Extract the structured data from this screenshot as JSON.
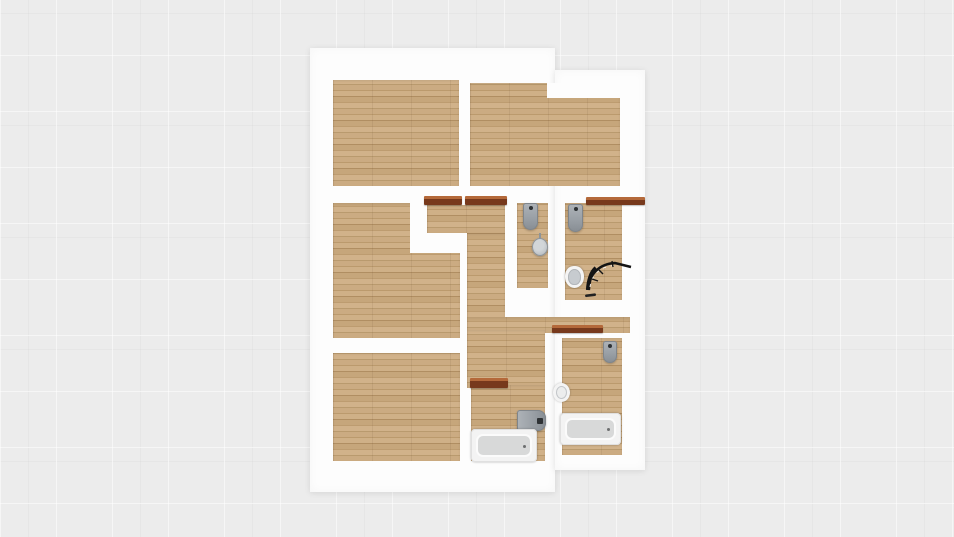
{
  "app": {
    "name": "floor-plan-viewer",
    "view": "2d-top-down-render",
    "visible_text": "none"
  },
  "palette": {
    "background": "#ececec",
    "wall": "#fdfdfd",
    "floor_base": "#c7a77c",
    "floor_dark": "#b08e62",
    "floor_light": "#d1b28a",
    "door_frame_dark": "#77391c",
    "door_frame_light": "#b4693a",
    "fixture_gray": "#9aa0a6",
    "fixture_white": "#f4f4f4",
    "tub_inner": "#d8d9d9",
    "shower_frame": "#141414"
  },
  "plan": {
    "blocks": [
      {
        "id": "building-block-main",
        "rect": [
          310,
          48,
          245,
          444
        ]
      },
      {
        "id": "building-block-right",
        "rect": [
          555,
          70,
          90,
          400
        ]
      }
    ],
    "rooms": [
      {
        "id": "floor-bedroom-top-left",
        "rect": [
          333,
          80,
          126,
          106
        ]
      },
      {
        "id": "floor-bedroom-top-right",
        "rect": [
          470,
          83,
          150,
          103
        ]
      },
      {
        "id": "floor-bedroom-mid-left",
        "rect": [
          333,
          203,
          127,
          135
        ]
      },
      {
        "id": "floor-bedroom-bottom-left",
        "rect": [
          333,
          353,
          127,
          108
        ]
      },
      {
        "id": "floor-vestibule",
        "rect": [
          427,
          205,
          78,
          28
        ]
      },
      {
        "id": "floor-corridor",
        "rect": [
          467,
          233,
          38,
          90
        ]
      },
      {
        "id": "floor-hall-strip",
        "rect": [
          467,
          317,
          163,
          16
        ]
      },
      {
        "id": "floor-hall-lower",
        "rect": [
          467,
          330,
          78,
          58
        ]
      },
      {
        "id": "floor-bathroom-center",
        "rect": [
          471,
          385,
          74,
          76
        ]
      },
      {
        "id": "floor-bathroom-right",
        "rect": [
          562,
          338,
          60,
          117
        ]
      },
      {
        "id": "floor-wc-left",
        "rect": [
          517,
          203,
          31,
          85
        ]
      },
      {
        "id": "floor-wc-right",
        "rect": [
          565,
          203,
          57,
          97
        ]
      }
    ],
    "wall_notches": [
      {
        "id": "wall-notch-top-right-room",
        "rect": [
          547,
          83,
          73,
          15
        ]
      },
      {
        "id": "wall-notch-mid-left-a",
        "rect": [
          410,
          203,
          17,
          50
        ]
      },
      {
        "id": "wall-notch-mid-left-b",
        "rect": [
          427,
          233,
          33,
          20
        ]
      }
    ],
    "doors": [
      {
        "id": "door-frame-mid-left-room",
        "rect": [
          424,
          196,
          38,
          9
        ]
      },
      {
        "id": "door-frame-vestibule",
        "rect": [
          465,
          196,
          42,
          9
        ]
      },
      {
        "id": "lintel-wc-right",
        "rect": [
          586,
          197,
          59,
          8
        ]
      },
      {
        "id": "door-frame-bath-right",
        "rect": [
          552,
          325,
          51,
          8
        ]
      },
      {
        "id": "door-frame-bath-center",
        "rect": [
          470,
          378,
          38,
          10
        ]
      }
    ],
    "fixtures": [
      {
        "id": "wc-left-wall-toilet",
        "type": "tank_toilet",
        "rect": [
          523,
          203,
          15,
          27
        ]
      },
      {
        "id": "wc-left-pedestal-sink",
        "type": "round_sink_gray",
        "rect": [
          532,
          238,
          16,
          18
        ]
      },
      {
        "id": "wc-right-wall-toilet",
        "type": "tank_toilet",
        "rect": [
          568,
          204,
          15,
          28
        ]
      },
      {
        "id": "wc-right-toilet-bowl",
        "type": "toilet_bowl",
        "rect": [
          565,
          266,
          19,
          22
        ]
      },
      {
        "id": "wc-right-shower-enclosure",
        "type": "shower_arc",
        "rect": [
          585,
          260,
          48,
          40
        ]
      },
      {
        "id": "bath-center-cistern",
        "type": "tank_toilet_h",
        "rect": [
          517,
          410,
          29,
          21
        ]
      },
      {
        "id": "bath-center-bathtub",
        "type": "bathtub",
        "rect": [
          471,
          429,
          66,
          33
        ]
      },
      {
        "id": "bath-right-cistern",
        "type": "tank_toilet",
        "rect": [
          603,
          341,
          14,
          22
        ]
      },
      {
        "id": "bath-right-round-sink",
        "type": "round_sink_white",
        "rect": [
          553,
          383,
          17,
          19
        ]
      },
      {
        "id": "bath-right-bathtub",
        "type": "bathtub",
        "rect": [
          560,
          413,
          61,
          32
        ]
      }
    ]
  }
}
